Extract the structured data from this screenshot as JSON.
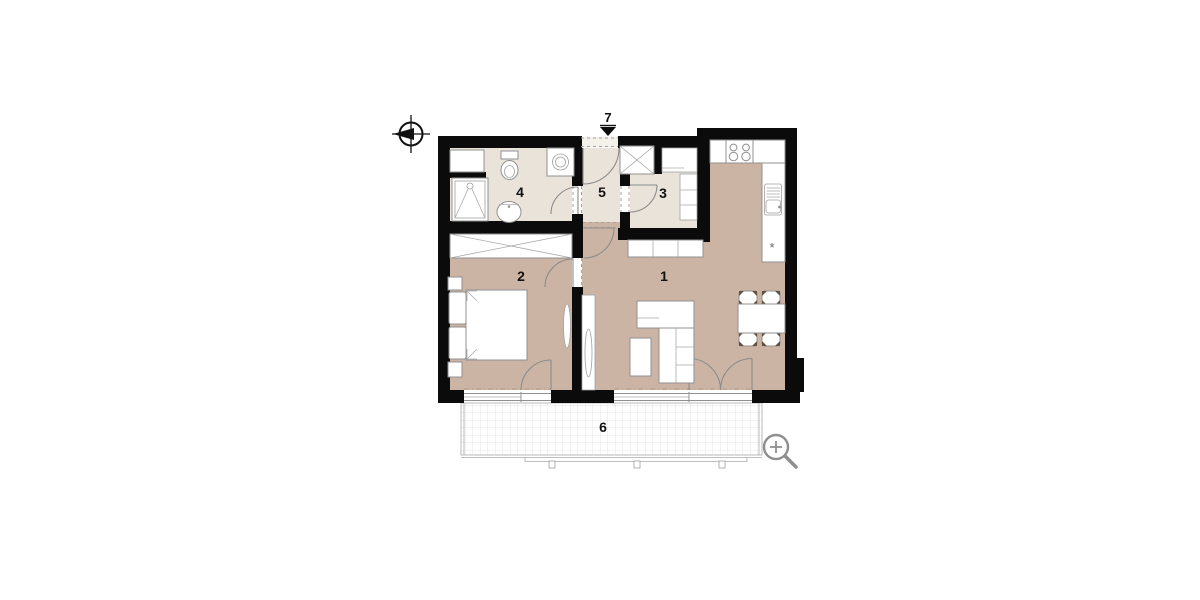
{
  "floor_plan": {
    "room_labels": {
      "living_room": "1",
      "bedroom": "2",
      "storage": "3",
      "bathroom": "4",
      "hallway": "5",
      "balcony": "6",
      "entrance": "7"
    },
    "symbols": {
      "appliance_marker": "*"
    },
    "icons": [
      "compass-icon",
      "entrance-arrow-icon",
      "magnifier-icon"
    ],
    "colors": {
      "floor_warm": "#cbb4a3",
      "floor_light": "#e9e3da",
      "wall": "#0b0b0b",
      "outline": "#8f8f8f",
      "balcony_grid": "#dedede"
    }
  }
}
